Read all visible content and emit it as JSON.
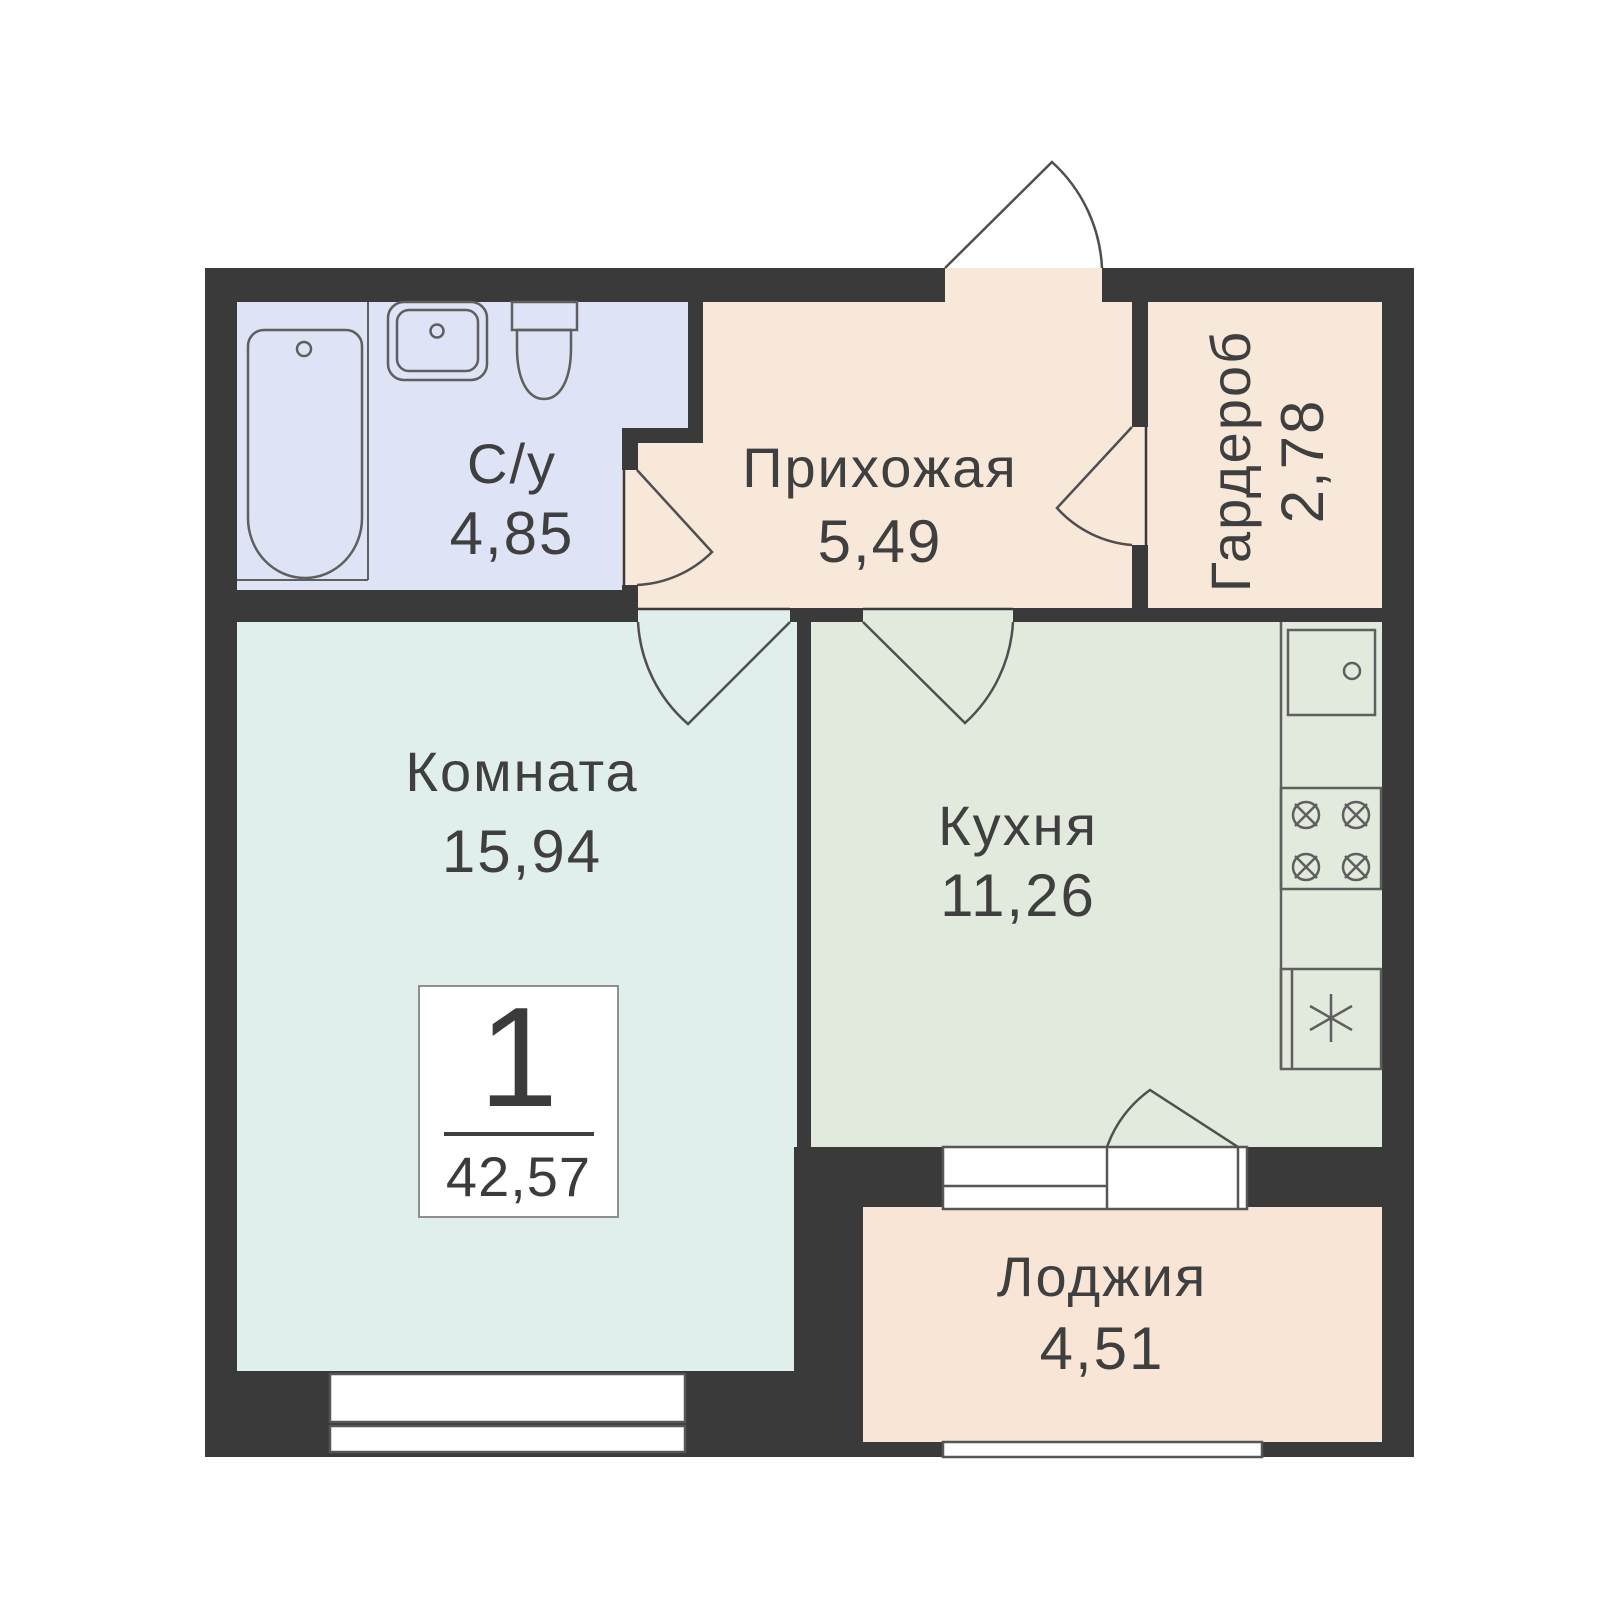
{
  "plan": {
    "badge": {
      "rooms_count": "1",
      "total_area": "42,57"
    },
    "rooms": [
      {
        "id": "bathroom",
        "label": "С/у",
        "area": "4,85"
      },
      {
        "id": "hallway",
        "label": "Прихожая",
        "area": "5,49"
      },
      {
        "id": "wardrobe",
        "label": "Гардероб",
        "area": "2,78"
      },
      {
        "id": "room",
        "label": "Комната",
        "area": "15,94"
      },
      {
        "id": "kitchen",
        "label": "Кухня",
        "area": "11,26"
      },
      {
        "id": "loggia",
        "label": "Лоджия",
        "area": "4,51"
      }
    ],
    "fixtures": [
      "bathtub",
      "bathroom-sink",
      "toilet",
      "kitchen-sink",
      "stove",
      "fridge"
    ],
    "colors": {
      "wall": "#3a3a3a",
      "bathroom": "#dee3f5",
      "hallway": "#f8e8da",
      "wardrobe": "#f8e8da",
      "room": "#e0eeec",
      "kitchen": "#e2eadd",
      "loggia": "#f8e5d5",
      "text": "#3f3f3f",
      "fixture_stroke": "#5f5f5f"
    }
  }
}
